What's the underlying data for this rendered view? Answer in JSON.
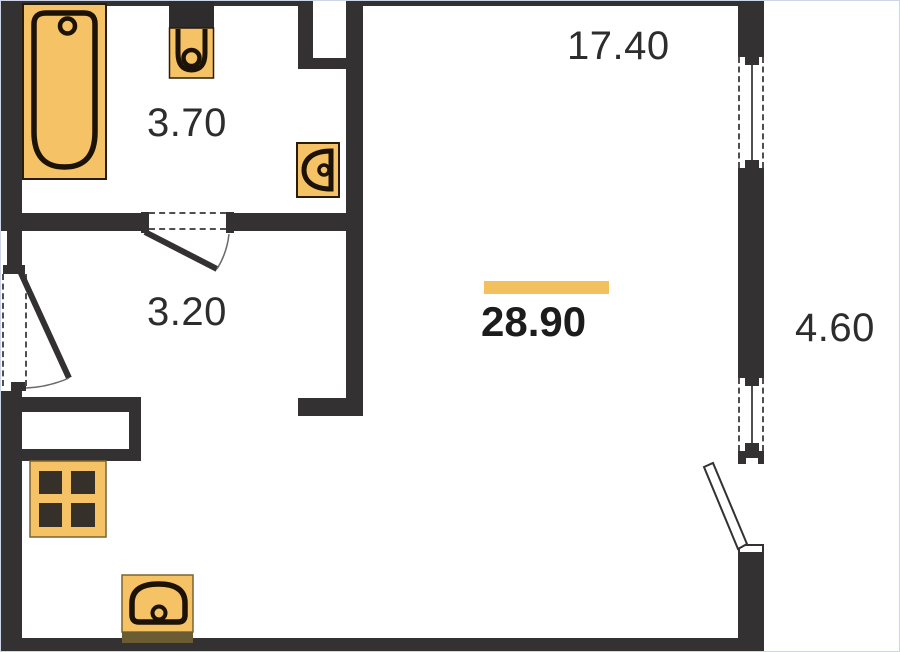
{
  "floorplan": {
    "labels": {
      "bathroom_area": "3.70",
      "hallway_area": "3.20",
      "main_room_area": "28.90",
      "upper_area": "17.40",
      "balcony_area": "4.60"
    },
    "colors": {
      "wall": "#333132",
      "fixture_fill": "#f5c266",
      "fixture_outline": "#1d1206",
      "highlight_bar": "#f2c05c",
      "dashed_opening": "#4f4f4f",
      "label_text": "#2d2d2d",
      "main_label_text": "#1c1c1c",
      "background": "#ffffff"
    },
    "icons": [
      "bathtub-icon",
      "toilet-icon",
      "washbasin-icon",
      "stove-icon",
      "kitchen-sink-icon",
      "window-icon",
      "door-leaf-icon",
      "balcony-door-icon"
    ]
  }
}
